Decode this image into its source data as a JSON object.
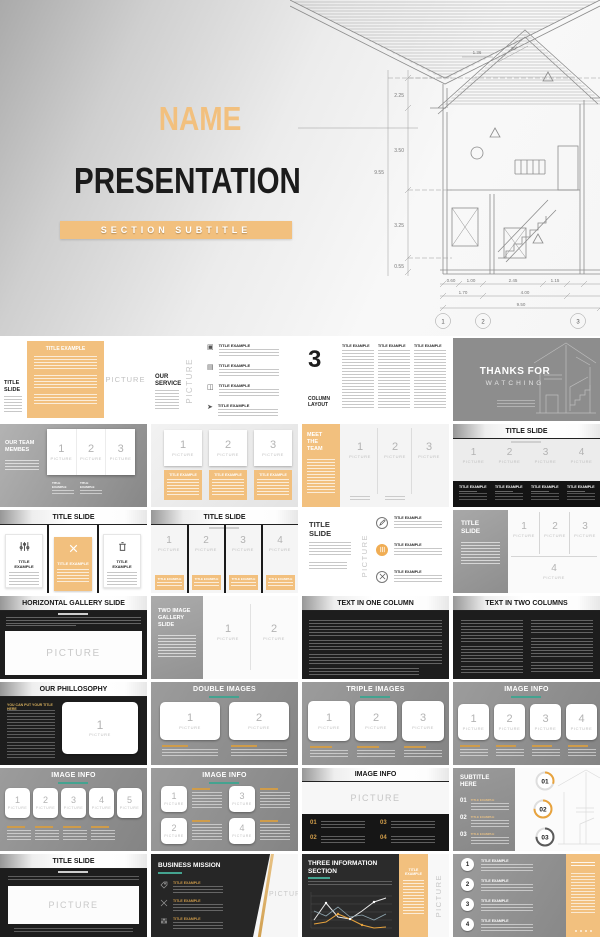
{
  "labels": {
    "picture": "PICTURE",
    "title_example": "TITLE EXAMPLE"
  },
  "colors": {
    "accent_orange": "#f2c07e",
    "gold": "#cf9c4a",
    "teal": "#44a390",
    "slide_gray": "#8e8e8e",
    "dark": "#1d1d1d"
  },
  "hero": {
    "name": "NAME",
    "presentation": "PRESENTATION",
    "subtitle": "SECTION SUBTITLE",
    "blueprint": {
      "d_left": [
        "2.25",
        "3.50",
        "3.25",
        "0.55"
      ],
      "d_total_left": "9.55",
      "d_top": "1.36",
      "angle": "30°",
      "d_bottom_row1": [
        "0.60",
        "1.00",
        "2.45",
        "1.15"
      ],
      "d_bottom_row2": [
        "1.70",
        "4.00"
      ],
      "d_bottom_total": "9.50",
      "markers": [
        "1",
        "2",
        "3"
      ]
    }
  },
  "slides": {
    "s0": {
      "side_title": "TITLE SLIDE"
    },
    "s1": {
      "title": "OUR SERVICE"
    },
    "s2": {
      "big_number": "3",
      "title": "COLUMN LAYOUT"
    },
    "s3": {
      "line1": "THANKS FOR",
      "line2": "WATCHING"
    },
    "s4": {
      "title": "OUR TEAM MEMBES",
      "nums": [
        "1",
        "2",
        "3"
      ]
    },
    "s5": {
      "nums": [
        "1",
        "2",
        "3"
      ]
    },
    "s6": {
      "title": "MEET THE TEAM",
      "nums": [
        "1",
        "2",
        "3"
      ]
    },
    "s7": {
      "title": "TITLE SLIDE",
      "nums": [
        "1",
        "2",
        "3",
        "4"
      ]
    },
    "s8": {
      "title": "TITLE SLIDE"
    },
    "s9": {
      "title": "TITLE SLIDE",
      "nums": [
        "1",
        "2",
        "3",
        "4"
      ]
    },
    "s10": {
      "title": "TITLE SLIDE"
    },
    "s11": {
      "title": "TITLE SLIDE",
      "nums": [
        "1",
        "2",
        "3",
        "4"
      ]
    },
    "s12": {
      "title": "HORIZONTAL GALLERY SLIDE"
    },
    "s13": {
      "title": "TWO IMAGE GALLERY SLIDE",
      "nums": [
        "1",
        "2"
      ]
    },
    "s14": {
      "title": "TEXT IN ONE COLUMN"
    },
    "s15": {
      "title": "TEXT IN TWO COLUMNS"
    },
    "s16": {
      "title": "OUR PHILLOSOPHY",
      "heading": "YOU CAN PUT YOUR TITLE HERE",
      "num": "1"
    },
    "s17": {
      "title": "DOUBLE IMAGES",
      "nums": [
        "1",
        "2"
      ]
    },
    "s18": {
      "title": "TRIPLE IMAGES",
      "nums": [
        "1",
        "2",
        "3"
      ]
    },
    "s19": {
      "title": "IMAGE INFO",
      "nums": [
        "1",
        "2",
        "3",
        "4"
      ]
    },
    "s20": {
      "title": "IMAGE INFO",
      "nums": [
        "1",
        "2",
        "3",
        "4",
        "5"
      ]
    },
    "s21": {
      "title": "IMAGE INFO",
      "nums": [
        "1",
        "2",
        "3",
        "4"
      ]
    },
    "s22": {
      "title": "IMAGE INFO",
      "nums": [
        "01",
        "02",
        "03",
        "04"
      ]
    },
    "s23": {
      "title": "SUBTITLE HERE",
      "item_nums": [
        "01",
        "02",
        "03"
      ],
      "rings": [
        "01",
        "02",
        "03"
      ]
    },
    "s24": {
      "title": "TITLE SLIDE"
    },
    "s25": {
      "title": "BUSINESS MISSION"
    },
    "s26": {
      "title": "THREE INFORMATION SECTION"
    },
    "s27": {
      "nums": [
        "1",
        "2",
        "3",
        "4"
      ]
    }
  }
}
